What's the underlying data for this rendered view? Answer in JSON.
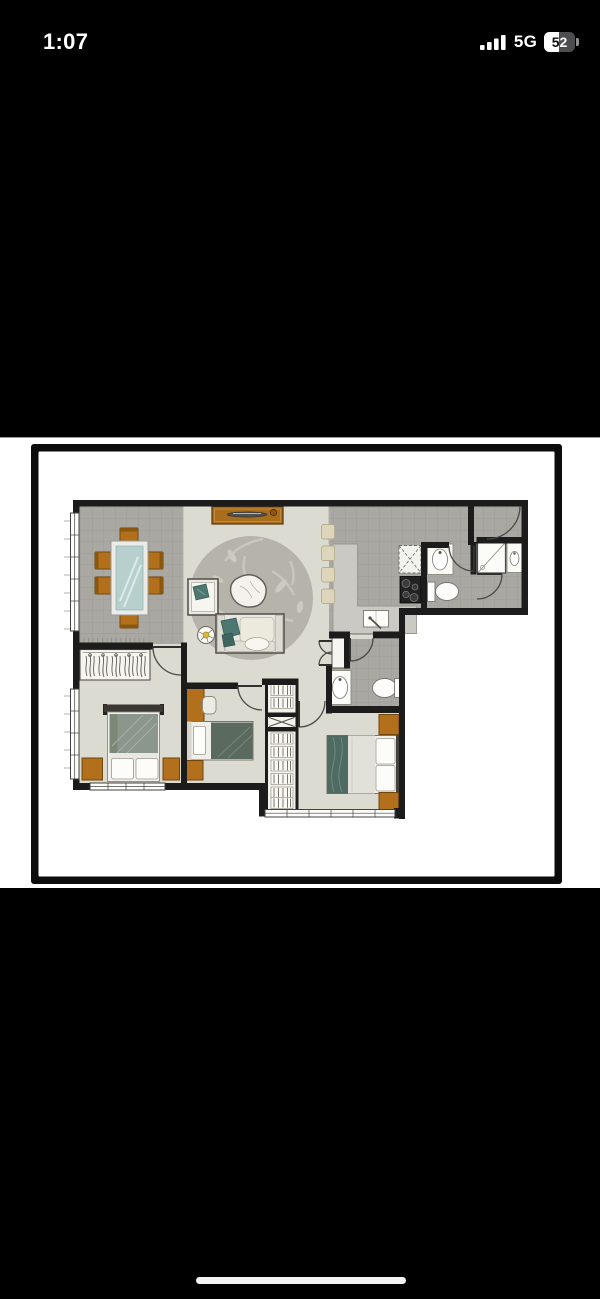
{
  "status_bar": {
    "time": "1:07",
    "network": "5G",
    "battery_percent": "52",
    "icons": [
      "cellular-signal-bars",
      "battery"
    ]
  },
  "photo": {
    "content": "apartment-floor-plan",
    "frame_color": "#0c0c0c",
    "background": "#ffffff"
  },
  "floor_plan": {
    "palette": {
      "floor": "#dcdbd2",
      "tile": "#a9a8a2",
      "tile_line": "#9b9a93",
      "wall": "#1c1c1c",
      "wood": "#b2701d",
      "wood_edge": "#6f460c",
      "glass_table": "#b7d0ce",
      "teal_fabric": "#4c7871",
      "bed_green": "#8b968c",
      "blanket_green": "#5a6a5f",
      "stool": "#ddd6ba",
      "rug": "#b6b4aa",
      "fixture": "#fdfdfb"
    }
  },
  "home_indicator": {
    "shape": "rounded-bar",
    "color": "#f4f4f4"
  }
}
